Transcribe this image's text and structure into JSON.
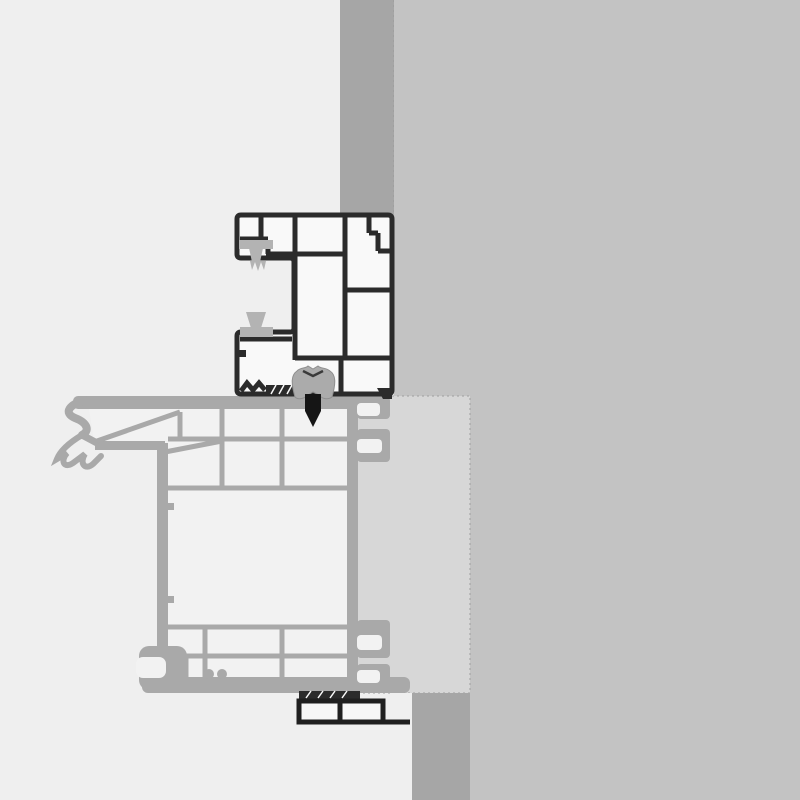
{
  "meta": {
    "description": "Technical cross-section detail drawing: window outer frame profile with brush seals installed at a wall reveal, above a gray sash/sill profile, insulation block and subsill section",
    "canvas": {
      "width": 800,
      "height": 800
    }
  },
  "colors": {
    "background": "#efefef",
    "wall_face": "#c3c3c3",
    "wall_reveal": "#a6a6a6",
    "insulation_block": "#d7d7d7",
    "edge_dash": "#9f9f9f",
    "frame_fill": "#f9f9f9",
    "frame_line": "#2b2b2b",
    "sash_line": "#a9a9a9",
    "sash_fill": "#f2f2f2",
    "seal_gray": "#b3b3b3",
    "gasket_gray": "#ababab",
    "gasket_edge": "#8f8f8f",
    "gasket_mark": "#3a3a3a",
    "arrow_black": "#151515",
    "subsill_line": "#1f1f1f",
    "subsill_fill": "#f7f7f7"
  },
  "parts": {
    "wall_face": "rendered wall face",
    "wall_reveal_top": "reveal render strip above frame",
    "wall_reveal_bottom": "reveal render strip below sill",
    "insulation_block": "insulation / packing block",
    "outer_frame_profile": "dark outer frame profile with chambers",
    "brush_seal_top": "upper brush seal",
    "brush_seal_bottom": "lower wedge seal",
    "center_gasket": "center sealing gasket",
    "fastener_arrow": "fixing screw direction arrow",
    "sash_profile": "gray sash / sill carrier profile",
    "subsill_profile": "dark subsill extension profile"
  }
}
